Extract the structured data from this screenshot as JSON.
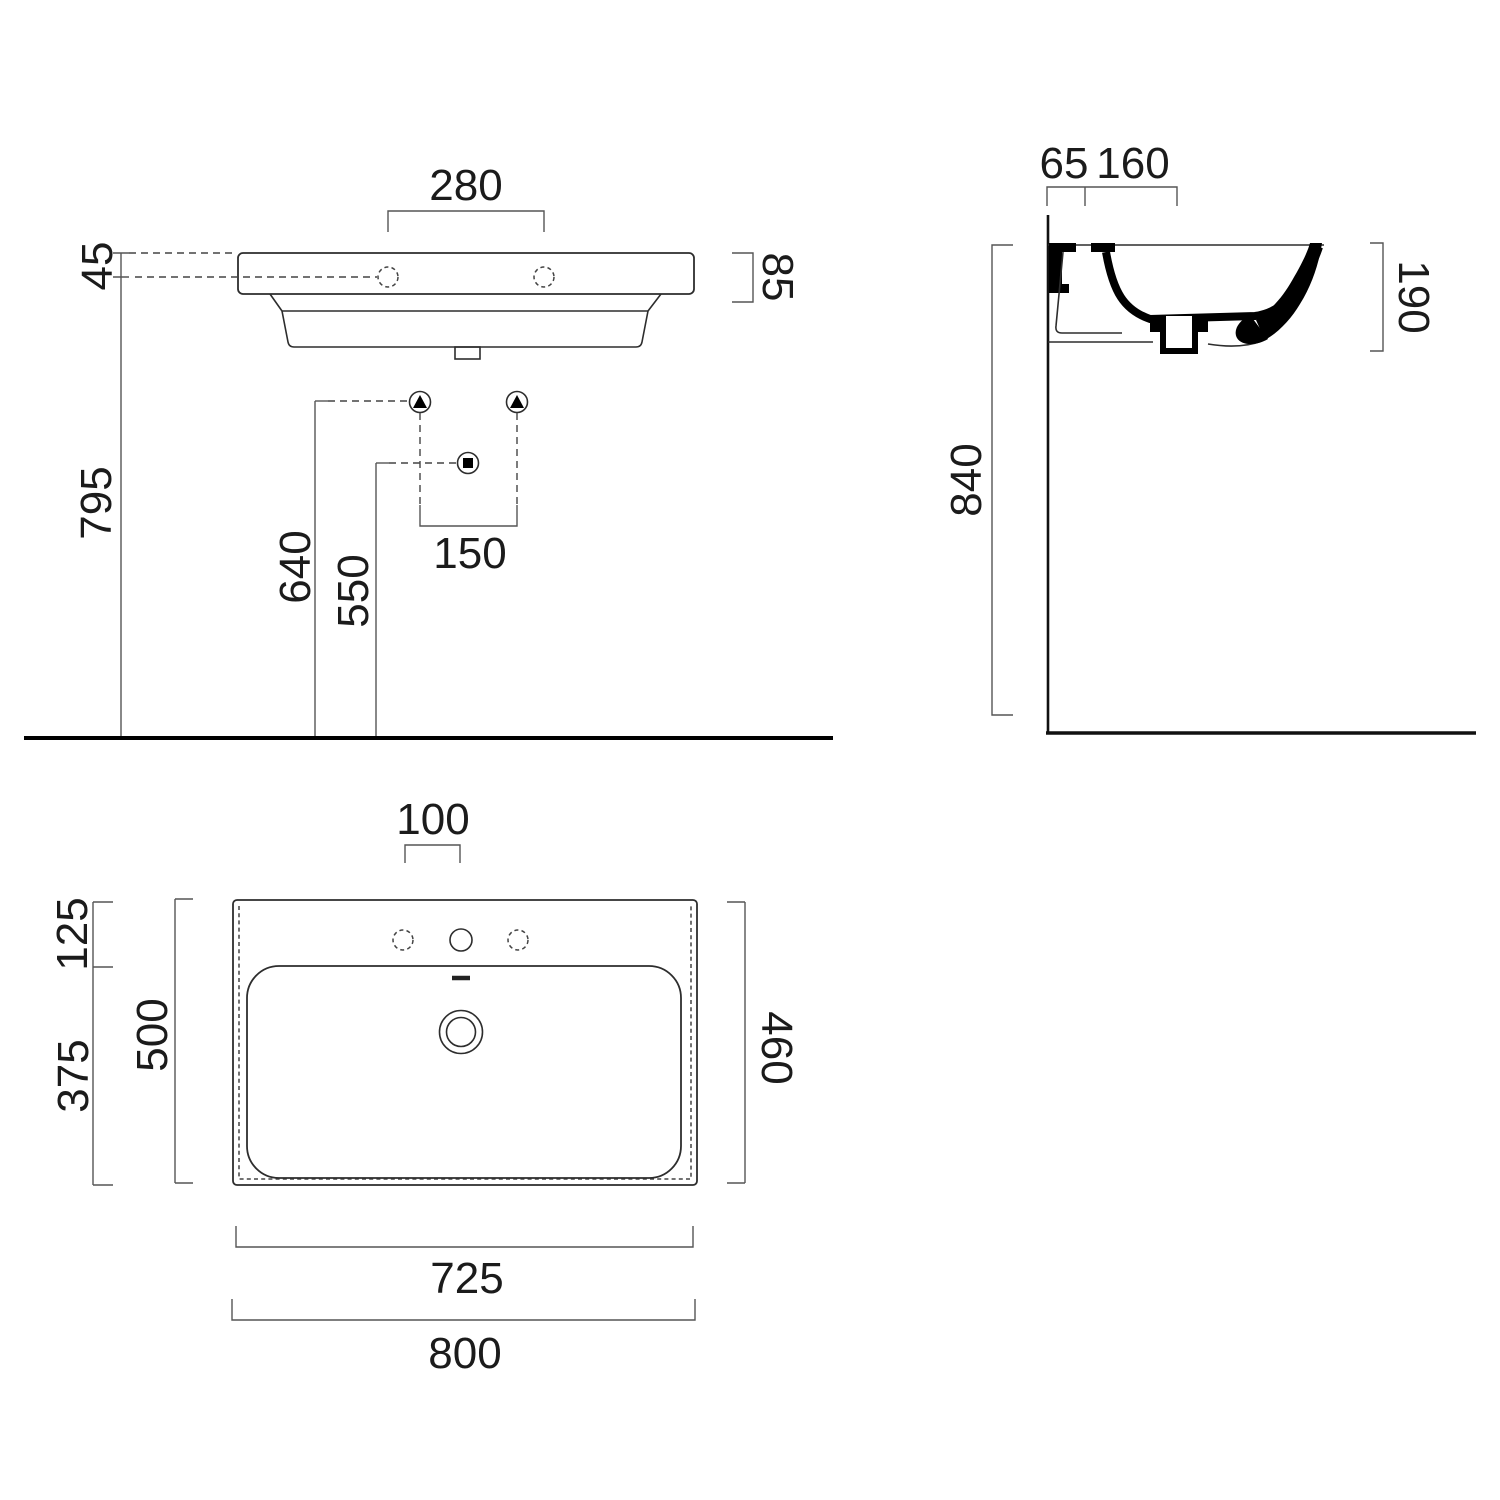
{
  "drawing": {
    "product": "wall-hung washbasin technical drawing",
    "units": "mm",
    "front_view": {
      "hole_spacing": "280",
      "rim_to_hole_drop": "45",
      "rim_thickness": "85",
      "rim_height": "795",
      "supply_height": "640",
      "drain_height": "550",
      "supply_spacing": "150"
    },
    "side_view": {
      "wall_clearance": "65",
      "deck_depth": "160",
      "basin_height": "190",
      "overall_height": "840"
    },
    "plan_view": {
      "faucet_spacing": "100",
      "deck_depth": "125",
      "bowl_depth": "375",
      "overall_depth": "500",
      "inner_depth": "460",
      "inner_width": "725",
      "overall_width": "800"
    }
  },
  "colors": {
    "background": "#ffffff",
    "line": "#2d2d2d",
    "section_fill": "#000000",
    "text": "#1b1b1b"
  }
}
